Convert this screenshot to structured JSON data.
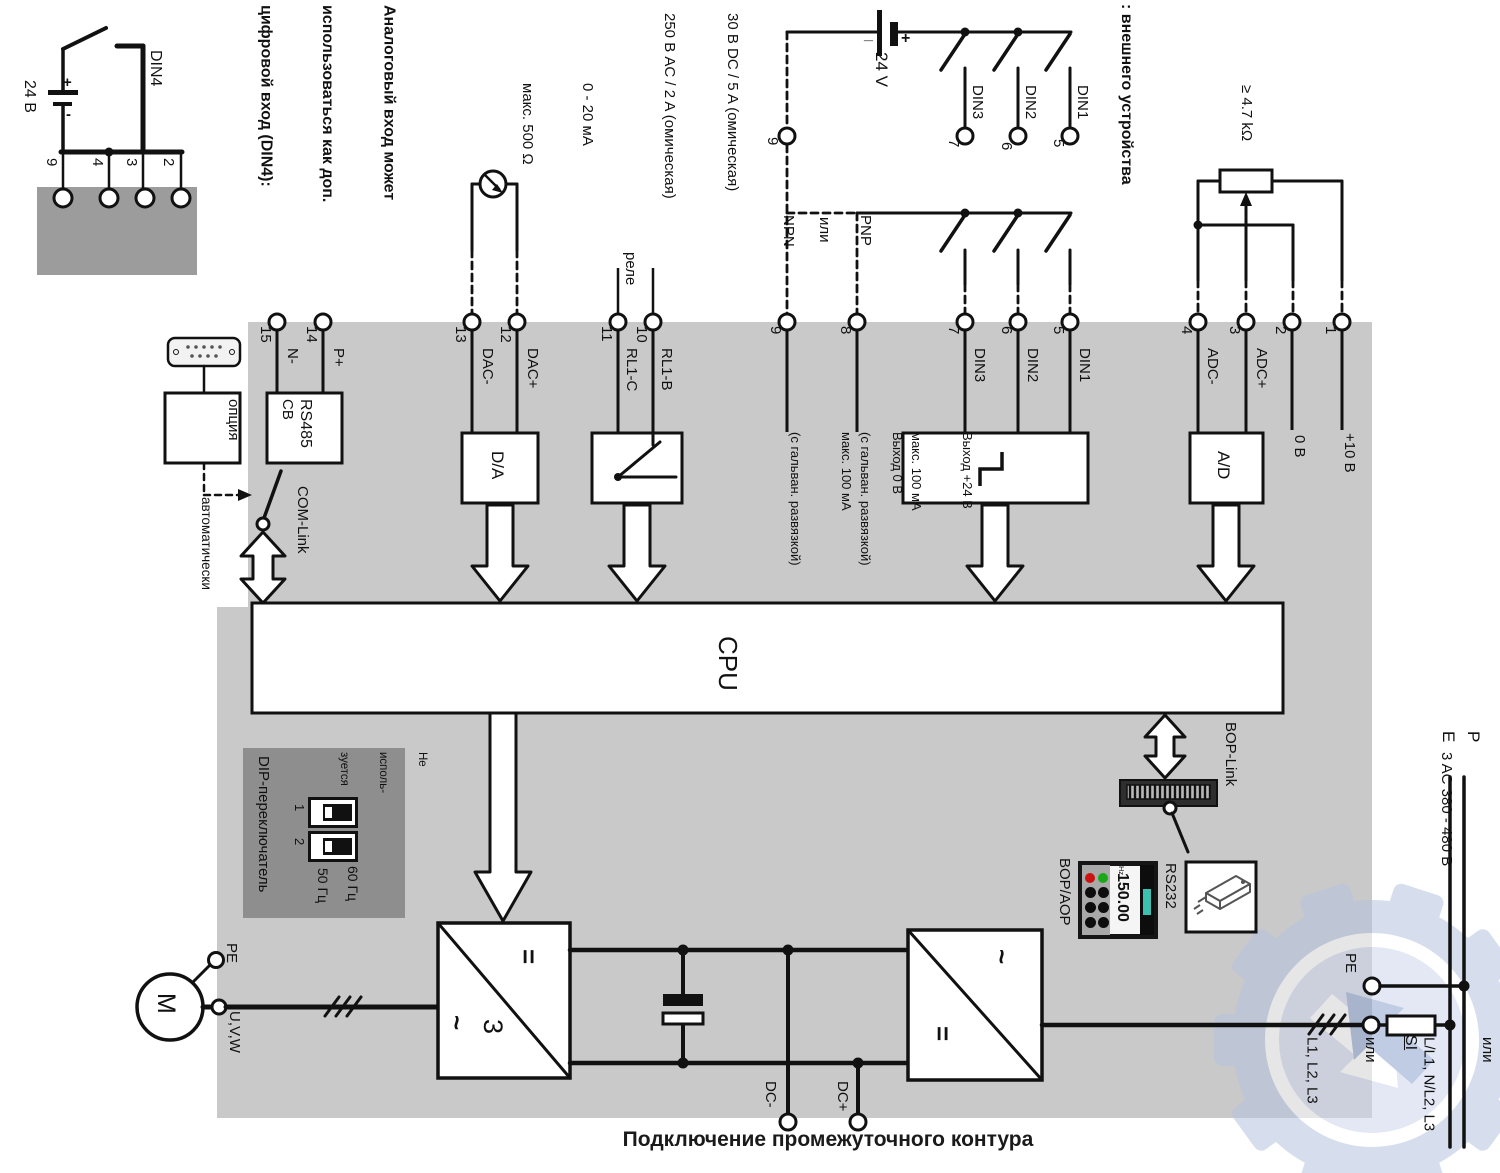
{
  "caption": "Подключение промежуточного контура",
  "note_din4": {
    "l1": "Аналоговый вход может",
    "l2": "использоваться как доп.",
    "l3": "цифровой вход (DIN4):"
  },
  "din4_circuit": {
    "label": "DIN4",
    "battery": "24 В",
    "plus": "+",
    "minus": "-",
    "t9": "9",
    "t4": "4",
    "t3": "3",
    "t2": "2"
  },
  "analog_out": {
    "l1": "0 - 20 мА",
    "l2": "макс. 500 Ω"
  },
  "relay_ext": {
    "rating1": "30 В DC / 5 A (омическая)",
    "rating2": "250 В AC / 2 A (омическая)",
    "label": "реле"
  },
  "ext_device": {
    "note": ": внешнего устройства",
    "battery": "24 V",
    "plus": "+",
    "minus": "_",
    "din1": "DIN1",
    "din2": "DIN2",
    "din3": "DIN3",
    "t9": "9",
    "t7": "7",
    "t6": "6",
    "t5": "5",
    "npn": "NPN",
    "or": "или",
    "pnp": "PNP"
  },
  "pot": {
    "label": "≥ 4.7 kΩ"
  },
  "terminals": {
    "t15": "15",
    "t14": "14",
    "t13": "13",
    "t12": "12",
    "t11": "11",
    "t10": "10",
    "t9": "9",
    "t8": "8",
    "t7": "7",
    "t6": "6",
    "t5": "5",
    "t4": "4",
    "t3": "3",
    "t2": "2",
    "t1": "1"
  },
  "signals": {
    "n_minus": "N-",
    "p_plus": "P+",
    "dac_minus": "DAC-",
    "dac_plus": "DAC+",
    "rl1c": "RL1-C",
    "rl1b": "RL1-B",
    "din3": "DIN3",
    "din2": "DIN2",
    "din1": "DIN1",
    "adc_minus": "ADC-",
    "adc_plus": "ADC+",
    "v0": "0 В",
    "v10": "+10 В"
  },
  "outputs": {
    "out0_l1": "Выход 0 В",
    "out0_l2": "макс. 100 мА",
    "out0_l3": "(с гальван. развязкой)",
    "out24_l1": "Выход +24 В",
    "out24_l2": "макс. 100 мА",
    "out24_l3": "(с гальван. развязкой)"
  },
  "blocks": {
    "cb_l1": "CB",
    "cb_l2": "опция",
    "rs485": "RS485",
    "auto": "автоматически",
    "com_link": "COM-Link",
    "cpu": "CPU",
    "da": "D/A",
    "ad": "A/D"
  },
  "dip": {
    "title": "DIP-переключатель",
    "nu1": "Не",
    "nu2": "исполь-",
    "nu3": "зуется",
    "s1": "1",
    "s2": "2",
    "hz60": "60 Гц",
    "hz50": "50 Гц"
  },
  "bop": {
    "link": "BOP-Link",
    "panel": "BOP/AOP",
    "display": "150.00",
    "hz": "Hz",
    "rs232": "RS232"
  },
  "power": {
    "motor": "M",
    "pe_motor": "PE",
    "uvw": "U,V,W",
    "inv_eq": "=",
    "inv_3": "3",
    "inv_tilde": "~",
    "rect_tilde": "~",
    "rect_eq": "=",
    "dc_minus": "DC-",
    "dc_plus": "DC+"
  },
  "mains": {
    "pe": "PE",
    "p": "P",
    "e": "E",
    "volt1": "1/3 AC 200 - 240 В",
    "volt2": "3 AC 380 - 480 В",
    "si": "SI",
    "l1": "L/L1, N/L2",
    "or1": "или",
    "l2": "L/L1, N/L2, L3",
    "or2": "или",
    "l3": "L1, L2, L3"
  },
  "colors": {
    "panel_gray": "#c9c9c9",
    "dip_gray": "#8e8e8e",
    "display_teal": "#3cc0b2",
    "led_red": "#cc1111",
    "led_green": "#18a818",
    "watermark_blue": "#b6c2e0"
  }
}
